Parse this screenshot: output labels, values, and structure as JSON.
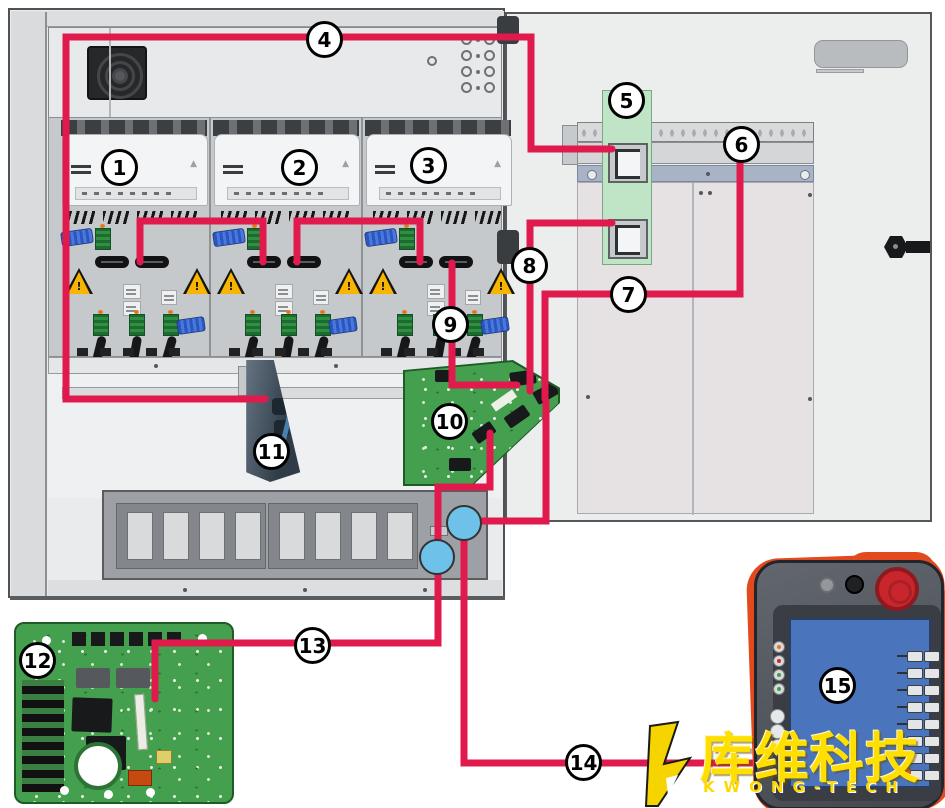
{
  "diagram_type": "controller-cabinet-wiring-overview",
  "colors": {
    "cable": "#e11a4e",
    "node_blue": "#6ec2ea",
    "board_green": "#bfe4c6",
    "pcb_green": "#44a04e",
    "screen_blue": "#4a74bb",
    "pendant_orange": "#e2491c",
    "warning_yellow": "#f7b500",
    "watermark_yellow": "#ffdf00"
  },
  "icons": {
    "warning_mark": "!",
    "vendor_logo_mark": "▲"
  },
  "callouts": [
    {
      "label": "1",
      "x": 120,
      "y": 168
    },
    {
      "label": "2",
      "x": 300,
      "y": 168
    },
    {
      "label": "3",
      "x": 429,
      "y": 166
    },
    {
      "label": "4",
      "x": 325,
      "y": 40
    },
    {
      "label": "5",
      "x": 627,
      "y": 101
    },
    {
      "label": "6",
      "x": 742,
      "y": 145
    },
    {
      "label": "7",
      "x": 629,
      "y": 295
    },
    {
      "label": "8",
      "x": 530,
      "y": 266
    },
    {
      "label": "9",
      "x": 451,
      "y": 325
    },
    {
      "label": "10",
      "x": 450,
      "y": 422
    },
    {
      "label": "11",
      "x": 272,
      "y": 452
    },
    {
      "label": "12",
      "x": 38,
      "y": 661
    },
    {
      "label": "13",
      "x": 313,
      "y": 646
    },
    {
      "label": "14",
      "x": 584,
      "y": 763
    },
    {
      "label": "15",
      "x": 838,
      "y": 686
    }
  ],
  "cables": [
    {
      "id": "cable-4",
      "points": "265,399 66,399 66,37 531,37 531,149 612,149"
    },
    {
      "id": "jumper-drive1-drive2",
      "points": "140,262 140,221 263,221 263,262"
    },
    {
      "id": "jumper-drive2-drive3",
      "points": "297,262 297,221 420,221 420,262"
    },
    {
      "id": "cable-9",
      "points": "452,263 452,385 517,385"
    },
    {
      "id": "cable-8",
      "points": "612,223 530,223 530,391"
    },
    {
      "id": "cable-6-7",
      "points": "740,158 740,294 545,294 545,399"
    },
    {
      "id": "cable-14",
      "points": "546,402 546,521 464,521 464,763 770,763"
    },
    {
      "id": "cable-13",
      "points": "490,433 490,487 438,487 438,643 155,643 155,699"
    }
  ],
  "nodes": [
    {
      "x": 464,
      "y": 523
    },
    {
      "x": 437,
      "y": 557
    }
  ],
  "drive_modules": {
    "count": 3,
    "lefts": [
      10,
      162,
      314
    ]
  },
  "pendant": {
    "side_key_rows": 8,
    "left_dot_colors": [
      "#e07820",
      "#cc2633",
      "#3f9e4b",
      "#3f9e4b"
    ],
    "left_plain_buttons": 3
  },
  "watermark": {
    "brand_cn": "库维科技",
    "brand_en": "KWONG-TECH"
  }
}
